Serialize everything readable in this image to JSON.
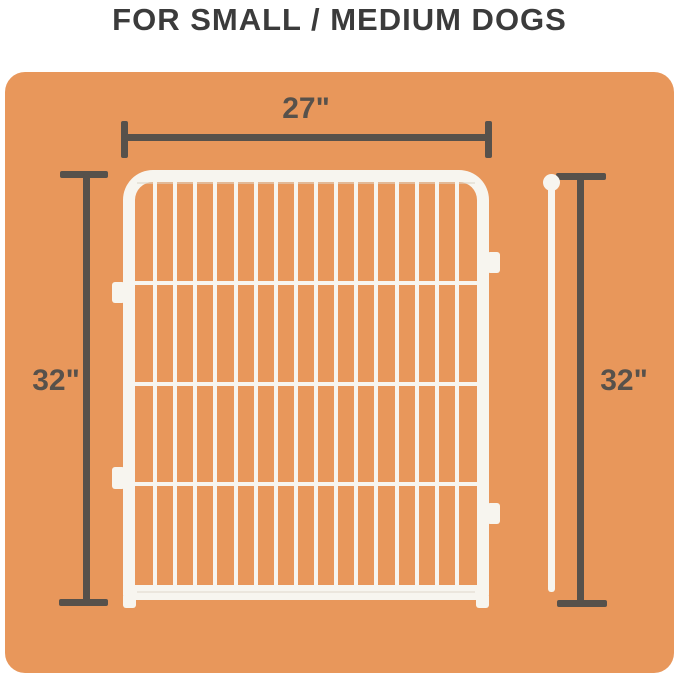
{
  "title": "FOR SMALL / MEDIUM DOGS",
  "dimensions": {
    "width_label": "27\"",
    "left_height_label": "32\"",
    "right_height_label": "32\""
  },
  "figure": {
    "type": "product-dimension-diagram",
    "panel_width_in": 27,
    "panel_height_in": 32,
    "pole_height_in": 32,
    "vertical_bar_count": 16,
    "crossbar_count": 3
  },
  "colors": {
    "background": "#FFFFFF",
    "card_orange": "#E8975B",
    "wire_white": "#F7F5EF",
    "dimension_line": "#57514B",
    "title_text": "#3B3B3B"
  },
  "icons": {
    "pole_ball": "connector-ball"
  }
}
